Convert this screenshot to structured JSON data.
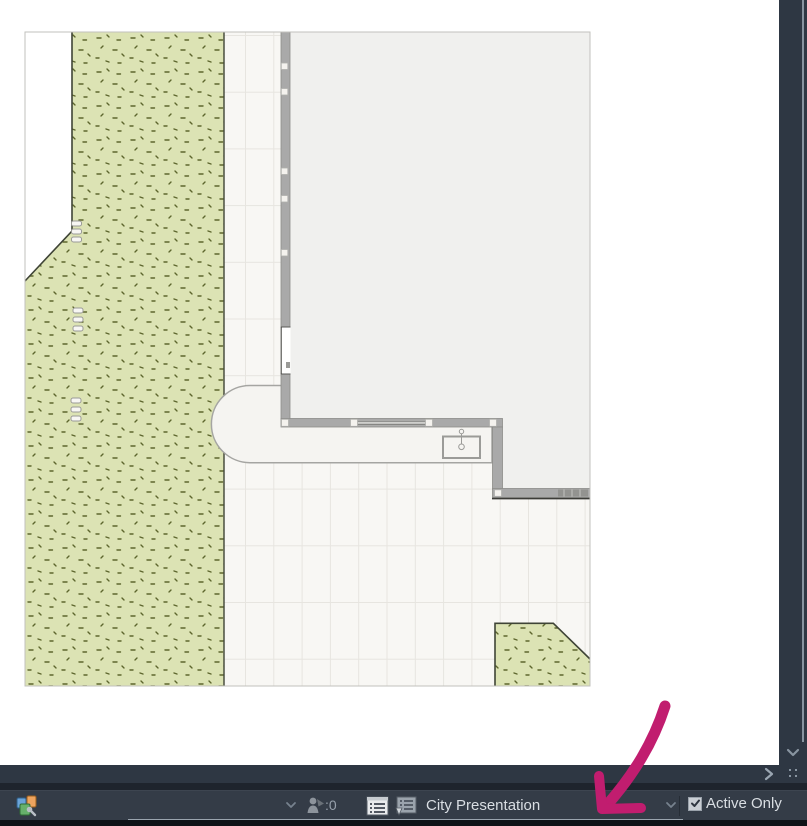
{
  "statusbar": {
    "teamwork_changes_count": ":0",
    "layout_name": "City Presentation",
    "active_only_label": "Active Only",
    "active_only_checked": true,
    "icons": [
      "quick-options-icon",
      "chevron-down-icon",
      "teamwork-person-icon",
      "list-view-icon",
      "layout-book-icon",
      "checkbox-checked"
    ]
  },
  "scrollbars": {
    "vertical_down_arrow": "chevron-down",
    "pane_expand_button": "chevron-right",
    "resize_grip": "dots-grip"
  },
  "annotation": {
    "type": "hand-drawn-arrow",
    "direction": "pointing-down-left-at-layout-field",
    "color": "#c11d6f"
  },
  "plan": {
    "description": "site plan viewport",
    "areas": [
      "grass-left-strip",
      "paved-tile-grid",
      "building-top-right",
      "rounded-terrace",
      "grass-bottom-right-wedge"
    ],
    "symbols": [
      "wall-openings",
      "wall-markers",
      "washbasin",
      "step-markers"
    ]
  },
  "colors": {
    "annotation": "#c11d6f",
    "grass": "#dce3b4",
    "grass_speckle": "#5d662d",
    "pavement": "#f8f7f4",
    "grid_line": "#e7e5e0",
    "wall": "#a9a9a9",
    "interior": "#f0f0ee",
    "ui_dark": "#343c47",
    "ui_darker": "#2e3743",
    "text_light": "#d9dee3"
  }
}
